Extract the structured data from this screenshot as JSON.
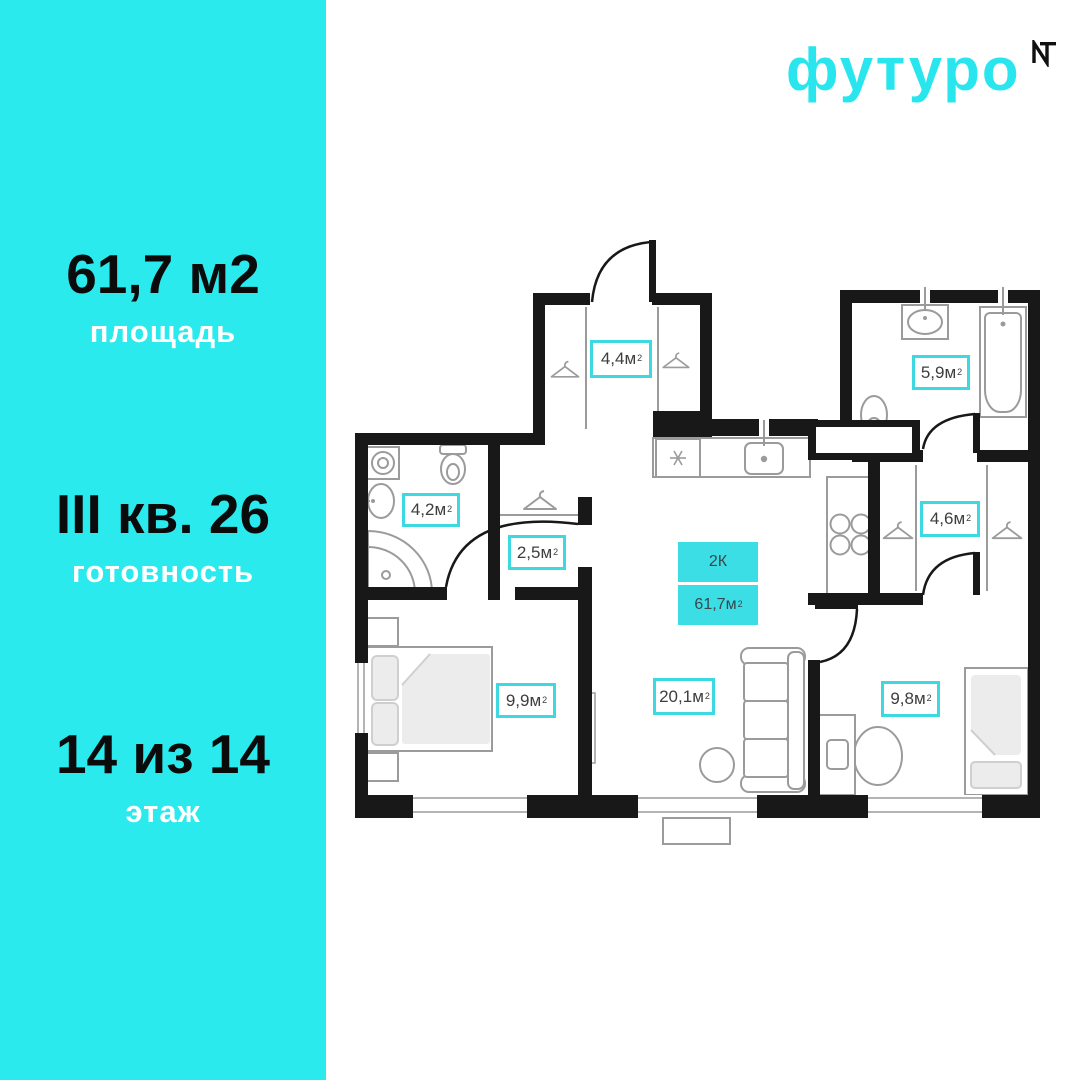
{
  "brand": {
    "name": "футуро",
    "logo_mark_icon": "nt-monogram",
    "accent_color": "#29E6EE"
  },
  "sidebar": {
    "bg_color": "#2BEAEE",
    "stats": [
      {
        "value": "61,7 м2",
        "label": "площадь"
      },
      {
        "value": "III кв. 26",
        "label": "готовность"
      },
      {
        "value": "14 из 14",
        "label": "этаж"
      }
    ]
  },
  "plan": {
    "unit": "м",
    "sup": "2",
    "badge": {
      "rooms_type": "2К",
      "area": "61,7"
    },
    "rooms": [
      {
        "id": "hallway-44",
        "area": "4,4"
      },
      {
        "id": "bathroom-59",
        "area": "5,9"
      },
      {
        "id": "bathroom-42",
        "area": "4,2"
      },
      {
        "id": "hallway-25",
        "area": "2,5"
      },
      {
        "id": "wardrobe-46",
        "area": "4,6"
      },
      {
        "id": "bedroom-99",
        "area": "9,9"
      },
      {
        "id": "living-201",
        "area": "20,1"
      },
      {
        "id": "room-98",
        "area": "9,8"
      }
    ],
    "colors": {
      "wall": "#181818",
      "furniture": "#9b9b9b",
      "label_border": "#3DD9E3",
      "badge_bg": "#3CDEE6"
    }
  }
}
